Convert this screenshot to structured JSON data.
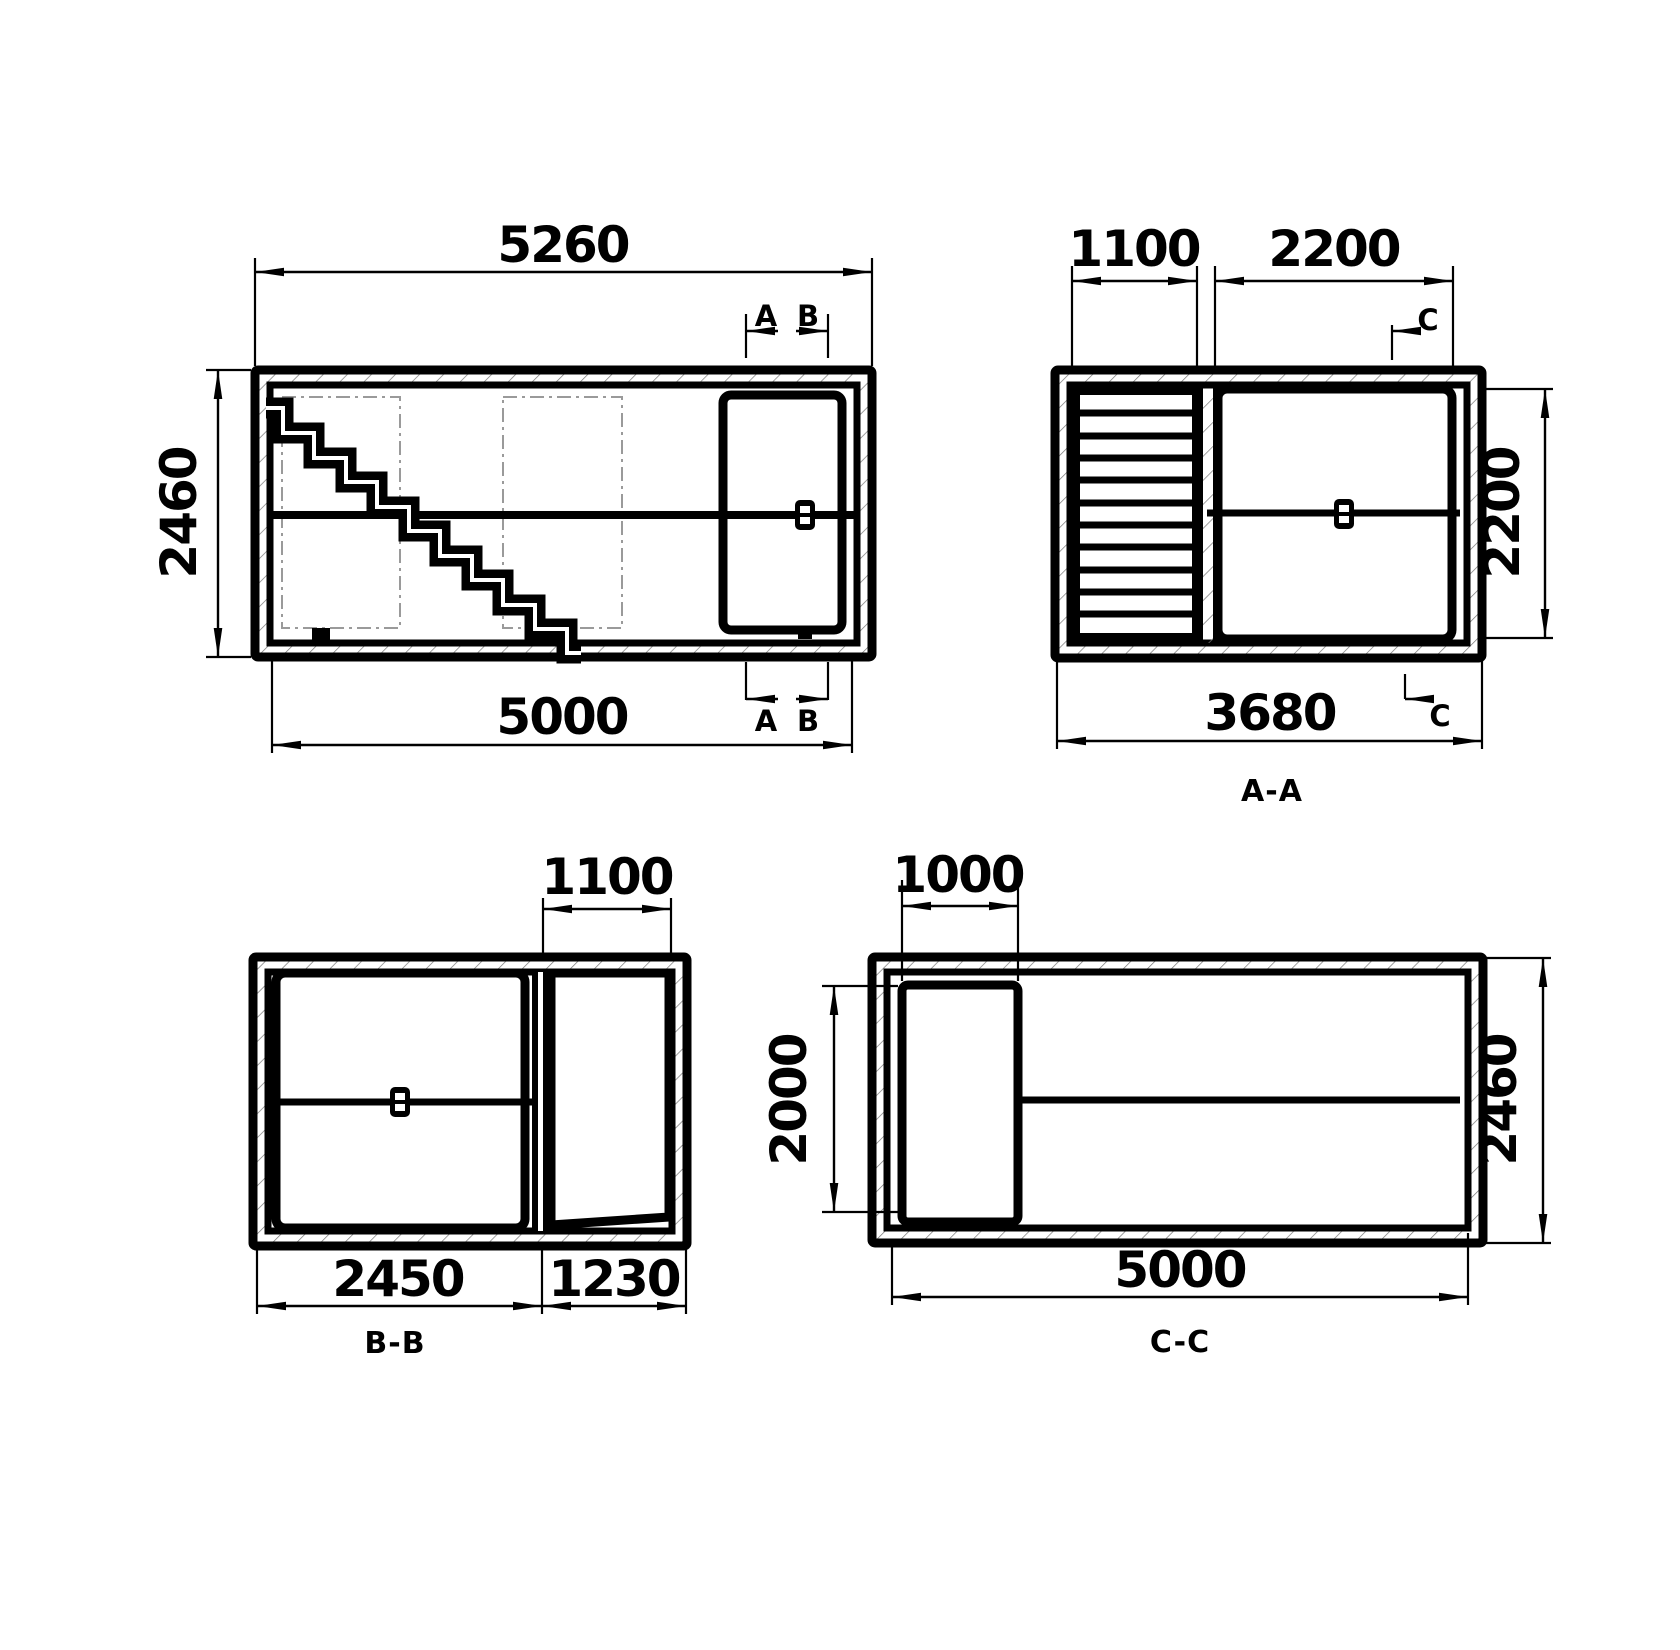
{
  "drawing": {
    "type": "technical-drawing",
    "line_color": "#000000",
    "background": "#ffffff",
    "views": {
      "plan": {
        "name": "floor-plan-view",
        "dim_top": "5260",
        "dim_left": "2460",
        "dim_bottom": "5000",
        "marker_a": "A",
        "marker_b": "B"
      },
      "section_aa": {
        "label": "A-A",
        "dim_stair_width": "1100",
        "dim_opening_width": "2200",
        "dim_opening_height": "2200",
        "dim_total_width": "3680",
        "marker_c": "C"
      },
      "section_bb": {
        "label": "B-B",
        "dim_door_width": "1100",
        "dim_left_zone": "2450",
        "dim_right_zone": "1230"
      },
      "section_cc": {
        "label": "C-C",
        "dim_door_width": "1000",
        "dim_door_height": "2000",
        "dim_height": "2460",
        "dim_length": "5000"
      }
    }
  }
}
